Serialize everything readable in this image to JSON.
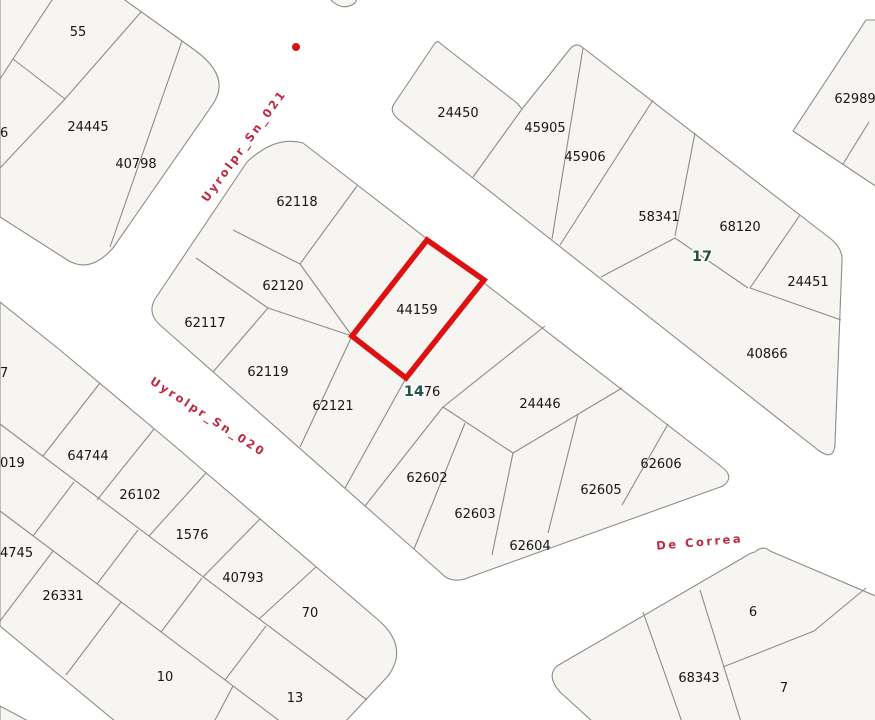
{
  "map": {
    "background_color": "#ffffff",
    "parcel_fill": "#f7f5f1",
    "parcel_stroke": "#8e8c88",
    "highlight_color": "#dd1111",
    "street_label_color": "#c02740",
    "block_label_color": "#215249",
    "parcel_label_color": "#161616",
    "selected_parcel": "44159",
    "marker_dot": {
      "x": 296,
      "y": 47,
      "radius": 4
    }
  },
  "street_labels": [
    {
      "text": "Uyrolpr_Sn_021",
      "x": 247,
      "y": 148,
      "rotation": -54
    },
    {
      "text": "Uyrolpr_Sn_020",
      "x": 206,
      "y": 420,
      "rotation": 33
    },
    {
      "text": "De Correa",
      "x": 700,
      "y": 546,
      "rotation": -5
    }
  ],
  "block_labels": [
    {
      "text": "17",
      "x": 702,
      "y": 261
    },
    {
      "text": "14",
      "x": 414,
      "y": 396
    }
  ],
  "parcel_labels": [
    {
      "text": "55",
      "x": 78,
      "y": 36
    },
    {
      "text": "24445",
      "x": 88,
      "y": 131
    },
    {
      "text": "40798",
      "x": 136,
      "y": 168
    },
    {
      "text": "6",
      "x": 0,
      "y": 137,
      "anchor": "start"
    },
    {
      "text": "62118",
      "x": 297,
      "y": 206
    },
    {
      "text": "62120",
      "x": 283,
      "y": 290
    },
    {
      "text": "62117",
      "x": 205,
      "y": 327
    },
    {
      "text": "62119",
      "x": 268,
      "y": 376
    },
    {
      "text": "62121",
      "x": 333,
      "y": 410
    },
    {
      "text": "44159",
      "x": 417,
      "y": 314
    },
    {
      "text": "76",
      "x": 432,
      "y": 396
    },
    {
      "text": "24446",
      "x": 540,
      "y": 408
    },
    {
      "text": "62602",
      "x": 427,
      "y": 482
    },
    {
      "text": "62603",
      "x": 475,
      "y": 518
    },
    {
      "text": "62604",
      "x": 530,
      "y": 550
    },
    {
      "text": "62605",
      "x": 601,
      "y": 494
    },
    {
      "text": "62606",
      "x": 661,
      "y": 468
    },
    {
      "text": "24450",
      "x": 458,
      "y": 117
    },
    {
      "text": "45905",
      "x": 545,
      "y": 132
    },
    {
      "text": "45906",
      "x": 585,
      "y": 161
    },
    {
      "text": "58341",
      "x": 659,
      "y": 221
    },
    {
      "text": "68120",
      "x": 740,
      "y": 231
    },
    {
      "text": "24451",
      "x": 808,
      "y": 286
    },
    {
      "text": "40866",
      "x": 767,
      "y": 358
    },
    {
      "text": "62989",
      "x": 855,
      "y": 103
    },
    {
      "text": "7",
      "x": 0,
      "y": 377,
      "anchor": "start"
    },
    {
      "text": "019",
      "x": 0,
      "y": 467,
      "anchor": "start"
    },
    {
      "text": "64744",
      "x": 88,
      "y": 460
    },
    {
      "text": "26102",
      "x": 140,
      "y": 499
    },
    {
      "text": "1576",
      "x": 192,
      "y": 539
    },
    {
      "text": "40793",
      "x": 243,
      "y": 582
    },
    {
      "text": "70",
      "x": 310,
      "y": 617
    },
    {
      "text": "4745",
      "x": 0,
      "y": 557,
      "anchor": "start"
    },
    {
      "text": "26331",
      "x": 63,
      "y": 600
    },
    {
      "text": "10",
      "x": 165,
      "y": 681
    },
    {
      "text": "13",
      "x": 295,
      "y": 702
    },
    {
      "text": "68343",
      "x": 699,
      "y": 682
    },
    {
      "text": "6",
      "x": 753,
      "y": 616
    },
    {
      "text": "7",
      "x": 784,
      "y": 692
    }
  ]
}
